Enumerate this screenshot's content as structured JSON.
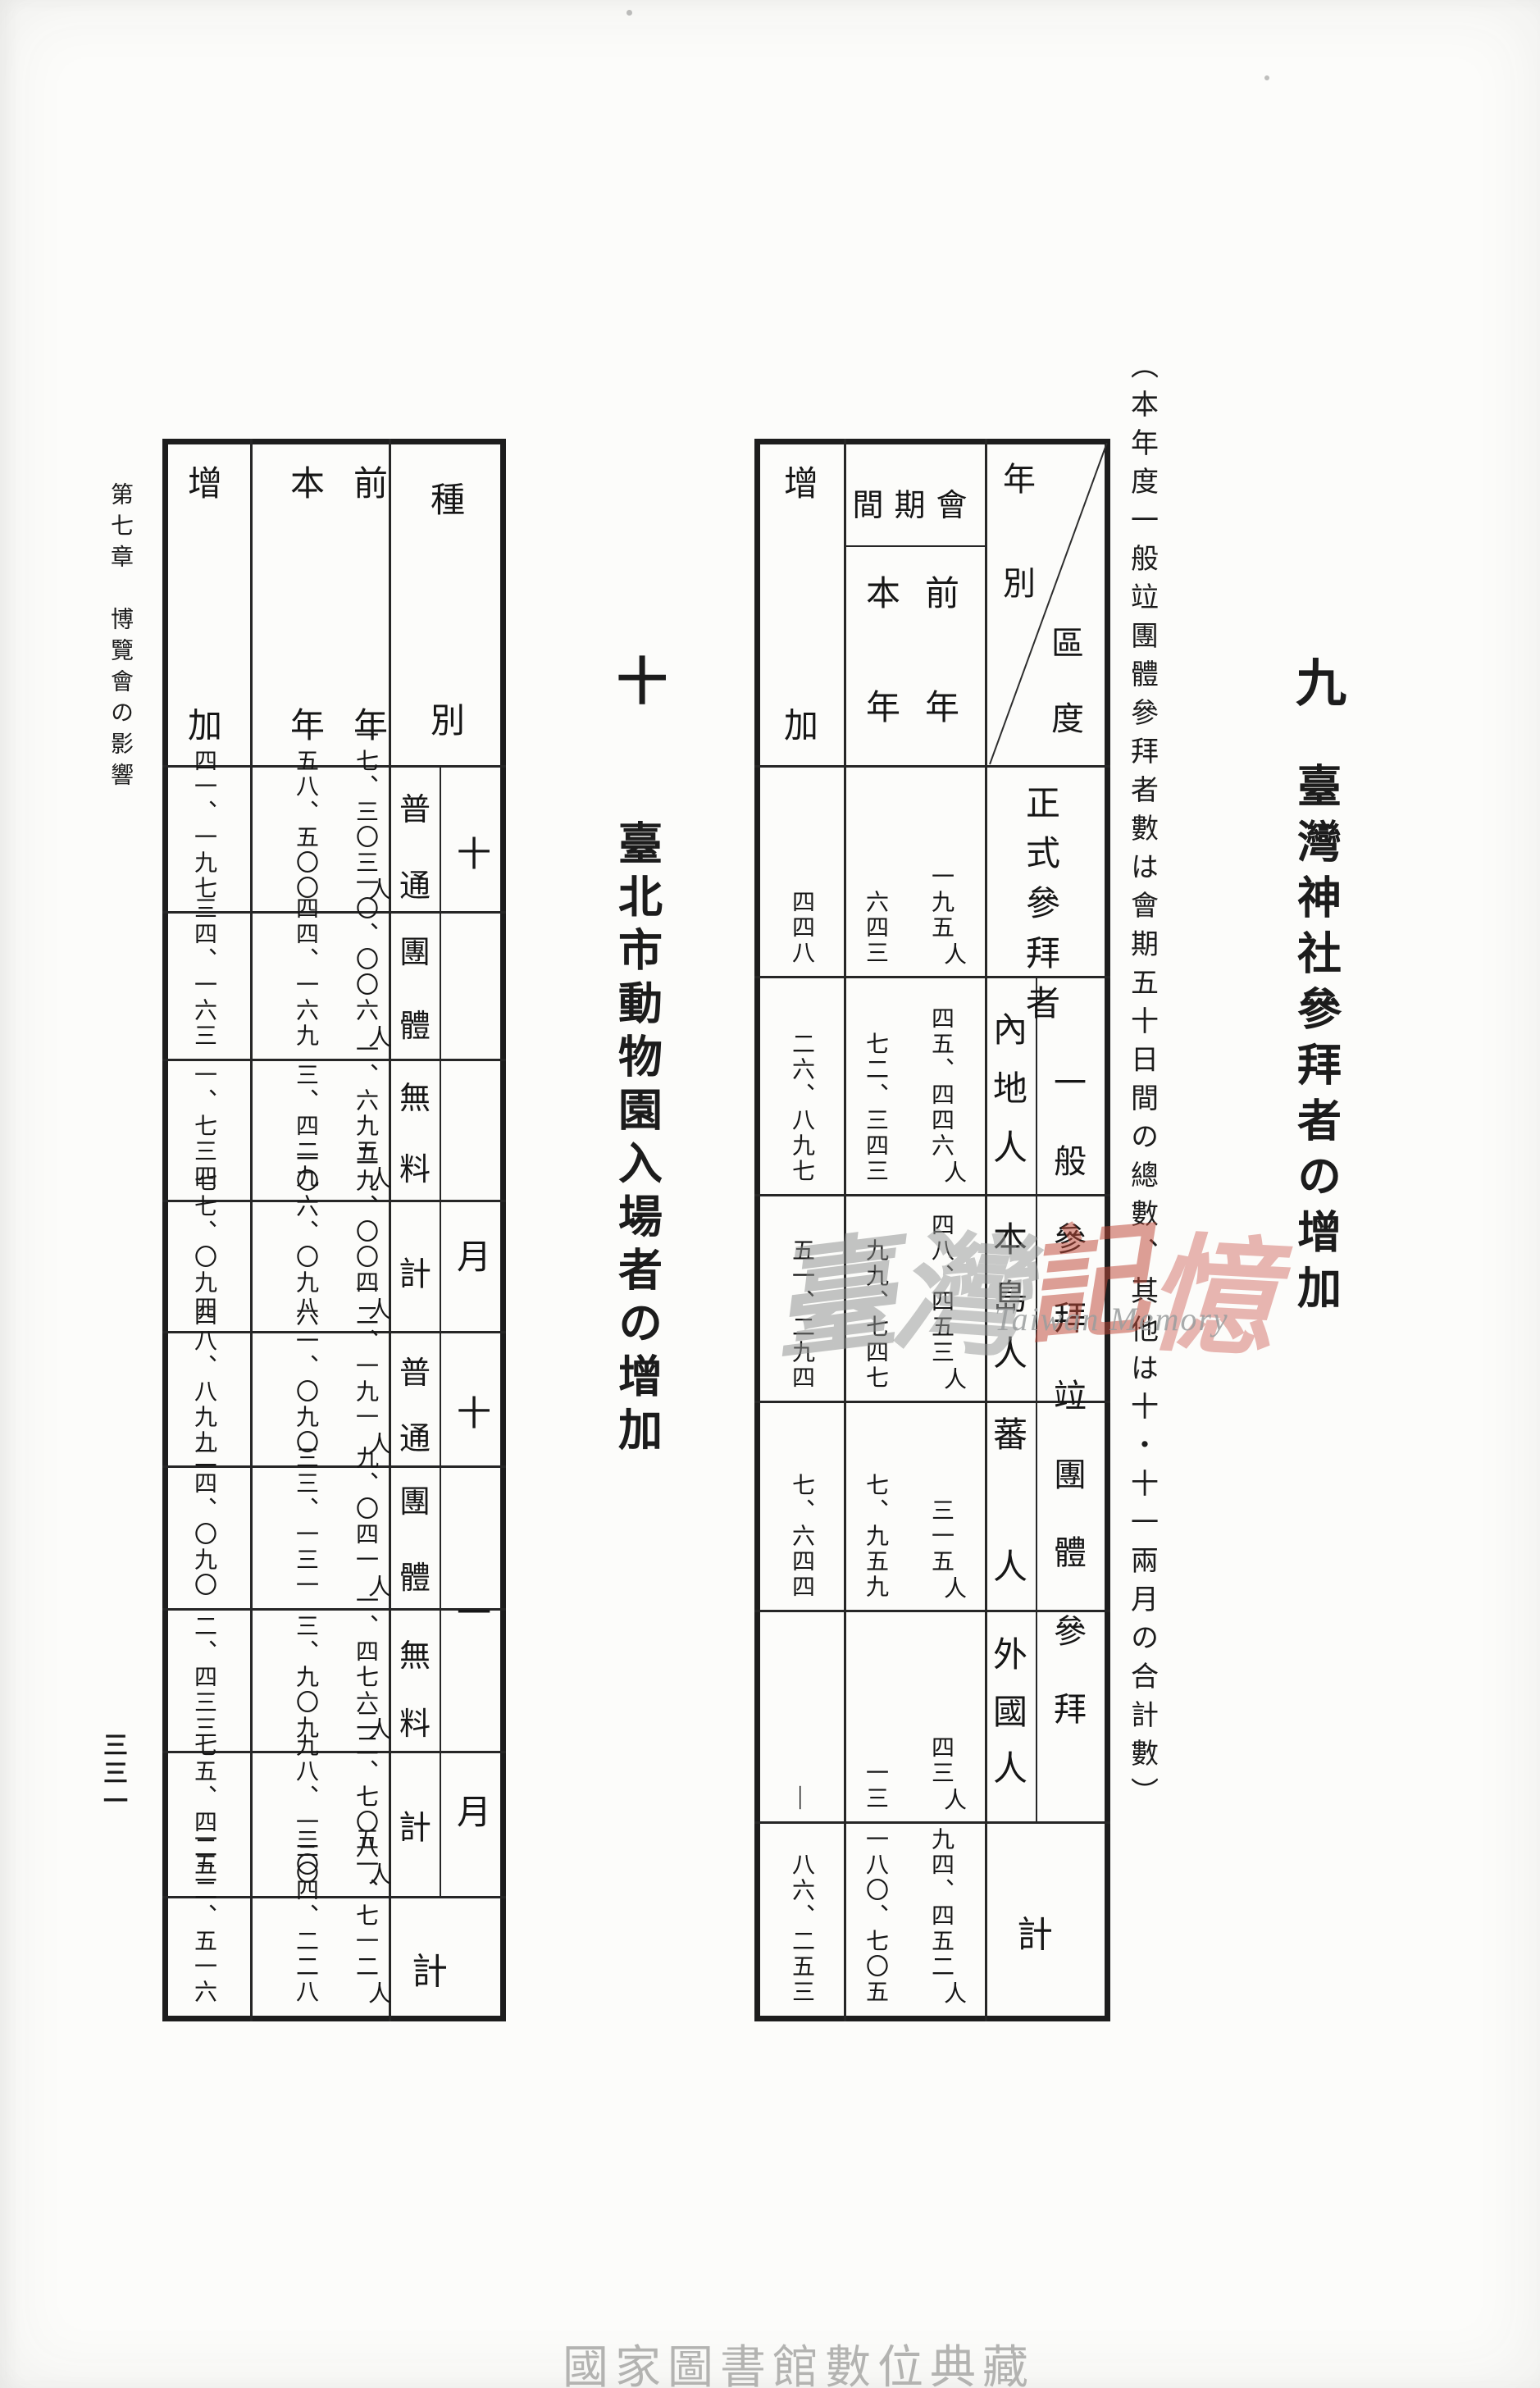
{
  "page": {
    "running_head": "第七章　博覽會の影響",
    "page_number": "三三一",
    "credit": "國家圖書館數位典藏",
    "watermark": {
      "char1": "臺",
      "char2": "灣",
      "char3": "記",
      "char4": "憶",
      "latin": "Taiwan Memory"
    }
  },
  "shrine": {
    "number": "九",
    "title": "臺灣神社參拜者の增加",
    "note": "（本年度一般竝團體參拜者數は會期五十日間の總數、其他は十・十一兩月の合計數）",
    "table": {
      "corner_top": "年別",
      "corner_bottom": "區度",
      "period_label": "會期間",
      "prev_label": "前年",
      "this_label": "本年",
      "increase_label": "增加",
      "general_label": "一般參拜竝團體參拜",
      "rows": [
        {
          "label": "正式參拜者",
          "prev": "一九五",
          "unit": "人",
          "cur": "六四三",
          "inc": "四四八"
        },
        {
          "label": "內地人",
          "prev": "四五、四四六",
          "unit": "人",
          "cur": "七二、三四三",
          "inc": "二六、八九七"
        },
        {
          "label": "本島人",
          "prev": "四八、四五三",
          "unit": "人",
          "cur": "九九、七四七",
          "inc": "五一、二九四"
        },
        {
          "label": "蕃人",
          "prev": "三一五",
          "unit": "人",
          "cur": "七、九五九",
          "inc": "七、六四四"
        },
        {
          "label": "外國人",
          "prev": "四三",
          "unit": "人",
          "cur": "一三",
          "inc": "―"
        },
        {
          "label": "計",
          "prev": "九四、四五二",
          "unit": "人",
          "cur": "一八〇、七〇五",
          "inc": "八六、二五三"
        }
      ]
    }
  },
  "zoo": {
    "number": "十",
    "title": "臺北市動物園入場者の增加",
    "table": {
      "type_label": "種別",
      "prev_label": "前年",
      "this_label": "本年",
      "increase_label": "增加",
      "oct_label": "十月",
      "nov_label": "十一月",
      "total_label": "計",
      "rows": [
        {
          "label": "普通",
          "prev": "一七、三〇三",
          "unit": "人",
          "cur": "五八、五〇〇",
          "inc": "四一、一九七"
        },
        {
          "label": "團體",
          "prev": "一〇、〇〇六",
          "unit": "人",
          "cur": "四四、一六九",
          "inc": "三四、一六三"
        },
        {
          "label": "無料",
          "prev": "一、六九五",
          "unit": "人",
          "cur": "三、四二九",
          "inc": "一、七三四"
        },
        {
          "label": "計",
          "prev": "二九、〇〇四",
          "unit": "人",
          "cur": "一〇六、〇九八",
          "inc": "七七、〇九四"
        },
        {
          "label": "普通",
          "prev": "一二、一九一",
          "unit": "人",
          "cur": "六一、〇九〇",
          "inc": "四八、八九九"
        },
        {
          "label": "團體",
          "prev": "九、〇四一",
          "unit": "人",
          "cur": "三三、一三一",
          "inc": "二四、〇九〇"
        },
        {
          "label": "無料",
          "prev": "一、四七六",
          "unit": "人",
          "cur": "三、九〇九",
          "inc": "二、四三三"
        },
        {
          "label": "計",
          "prev": "二二、七〇八",
          "unit": "人",
          "cur": "九八、一三〇",
          "inc": "七五、四二二"
        },
        {
          "label": "計",
          "prev": "五一、七一二",
          "unit": "人",
          "cur": "二〇四、二二八",
          "inc": "一五二、五一六"
        }
      ]
    }
  },
  "chart_data": [
    {
      "type": "table",
      "title": "九 臺灣神社參拜者の增加",
      "columns": [
        "區分",
        "前年",
        "本年",
        "增加"
      ],
      "rows": [
        [
          "正式參拜者",
          195,
          643,
          448
        ],
        [
          "一般參拜竝團體參拜 內地人",
          45446,
          72343,
          26897
        ],
        [
          "一般參拜竝團體參拜 本島人",
          48453,
          99747,
          51294
        ],
        [
          "一般參拜竝團體參拜 蕃人",
          315,
          7959,
          7644
        ],
        [
          "一般參拜竝團體參拜 外國人",
          43,
          13,
          null
        ],
        [
          "計",
          94452,
          180705,
          86253
        ]
      ]
    },
    {
      "type": "table",
      "title": "十 臺北市動物園入場者の增加",
      "columns": [
        "種別",
        "前年",
        "本年",
        "增加"
      ],
      "rows": [
        [
          "十月 普通",
          17303,
          58500,
          41197
        ],
        [
          "十月 團體",
          10006,
          44169,
          34163
        ],
        [
          "十月 無料",
          1695,
          3429,
          1734
        ],
        [
          "十月 計",
          29004,
          106098,
          77094
        ],
        [
          "十一月 普通",
          12191,
          61090,
          48899
        ],
        [
          "十一月 團體",
          9041,
          33131,
          24090
        ],
        [
          "十一月 無料",
          1476,
          3909,
          2433
        ],
        [
          "十一月 計",
          22708,
          98130,
          75422
        ],
        [
          "計",
          51712,
          204228,
          152516
        ]
      ]
    }
  ]
}
